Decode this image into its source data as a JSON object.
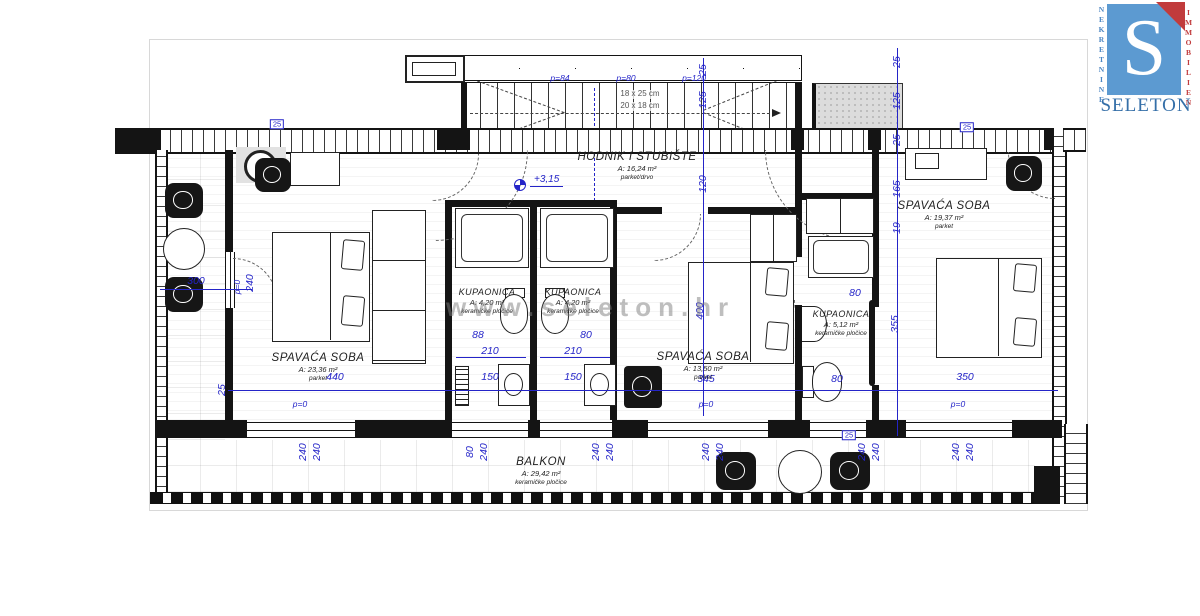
{
  "logo": {
    "letter": "S",
    "brand": "SELETON",
    "side_left": "NEKRETNINE",
    "side_right": "IMMOBILIEN",
    "blue": "#5c9ad1",
    "red": "#c13b3c",
    "brand_blue": "#356fa8"
  },
  "watermark": {
    "text": "www.seleton.hr"
  },
  "plan": {
    "level_marker": "+3,15",
    "stairs": {
      "note1": "18 x 25 cm",
      "note2": "20 x 18 cm"
    },
    "dim_color": "#2424c8",
    "rooms": [
      {
        "id": "hodnik",
        "name": "HODNIK I STUBIŠTE",
        "area": "A: 16,24 m²",
        "floor": "parket/drvo"
      },
      {
        "id": "bedroom-left",
        "name": "SPAVAĆA SOBA",
        "area": "A: 23,36 m²",
        "floor": "parket"
      },
      {
        "id": "bathroom-1",
        "name": "KUPAONICA",
        "area": "A: 4,20 m²",
        "floor": "keramičke pločice"
      },
      {
        "id": "bathroom-2",
        "name": "KUPAONICA",
        "area": "A: 4,20 m²",
        "floor": "keramičke pločice"
      },
      {
        "id": "bedroom-middle",
        "name": "SPAVAĆA SOBA",
        "area": "A: 13,50 m²",
        "floor": "parket"
      },
      {
        "id": "bathroom-3",
        "name": "KUPAONICA",
        "area": "A: 5,12 m²",
        "floor": "keramičke pločice"
      },
      {
        "id": "bedroom-right",
        "name": "SPAVAĆA SOBA",
        "area": "A: 19,37 m²",
        "floor": "parket"
      },
      {
        "id": "balkon",
        "name": "BALKON",
        "area": "A: 29,42 m²",
        "floor": "keramičke pločice"
      }
    ],
    "dimensions": [
      {
        "t": "440",
        "x": 335,
        "y": 377
      },
      {
        "t": "150",
        "x": 490,
        "y": 377
      },
      {
        "t": "150",
        "x": 573,
        "y": 377
      },
      {
        "t": "345",
        "x": 706,
        "y": 379
      },
      {
        "t": "80",
        "x": 837,
        "y": 379
      },
      {
        "t": "350",
        "x": 965,
        "y": 377
      },
      {
        "t": "88",
        "x": 478,
        "y": 335
      },
      {
        "t": "210",
        "x": 490,
        "y": 351
      },
      {
        "t": "80",
        "x": 586,
        "y": 335
      },
      {
        "t": "210",
        "x": 573,
        "y": 351
      },
      {
        "t": "80",
        "x": 855,
        "y": 293
      },
      {
        "t": "300",
        "x": 196,
        "y": 281
      },
      {
        "t": "25",
        "x": 897,
        "y": 62,
        "rot": -90
      },
      {
        "t": "125",
        "x": 897,
        "y": 101,
        "rot": -90
      },
      {
        "t": "25",
        "x": 897,
        "y": 140,
        "rot": -90
      },
      {
        "t": "165",
        "x": 897,
        "y": 189,
        "rot": -90
      },
      {
        "t": "19",
        "x": 897,
        "y": 228,
        "rot": -90
      },
      {
        "t": "355",
        "x": 895,
        "y": 324,
        "rot": -90
      },
      {
        "t": "25",
        "x": 703,
        "y": 70,
        "rot": -90
      },
      {
        "t": "125",
        "x": 703,
        "y": 100,
        "rot": -90
      },
      {
        "t": "120",
        "x": 703,
        "y": 184,
        "rot": -90
      },
      {
        "t": "400",
        "x": 700,
        "y": 311,
        "rot": -90
      },
      {
        "t": "25",
        "x": 222,
        "y": 390,
        "rot": -90
      },
      {
        "t": "240",
        "x": 303,
        "y": 452,
        "rot": -90
      },
      {
        "t": "240",
        "x": 317,
        "y": 452,
        "rot": -90
      },
      {
        "t": "80",
        "x": 470,
        "y": 452,
        "rot": -90
      },
      {
        "t": "240",
        "x": 484,
        "y": 452,
        "rot": -90
      },
      {
        "t": "240",
        "x": 596,
        "y": 452,
        "rot": -90
      },
      {
        "t": "240",
        "x": 610,
        "y": 452,
        "rot": -90
      },
      {
        "t": "240",
        "x": 706,
        "y": 452,
        "rot": -90
      },
      {
        "t": "240",
        "x": 720,
        "y": 452,
        "rot": -90
      },
      {
        "t": "240",
        "x": 862,
        "y": 452,
        "rot": -90
      },
      {
        "t": "240",
        "x": 876,
        "y": 452,
        "rot": -90
      },
      {
        "t": "240",
        "x": 956,
        "y": 452,
        "rot": -90
      },
      {
        "t": "240",
        "x": 970,
        "y": 452,
        "rot": -90
      },
      {
        "t": "240",
        "x": 250,
        "y": 283,
        "rot": -90
      },
      {
        "t": "p=0",
        "x": 237,
        "y": 287,
        "rot": -90,
        "style": "label"
      },
      {
        "t": "p=0",
        "x": 300,
        "y": 404,
        "style": "label"
      },
      {
        "t": "p=0",
        "x": 706,
        "y": 404,
        "style": "label"
      },
      {
        "t": "p=0",
        "x": 958,
        "y": 404,
        "style": "label"
      },
      {
        "t": "p=84",
        "x": 560,
        "y": 78,
        "style": "label"
      },
      {
        "t": "p=80",
        "x": 626,
        "y": 78,
        "style": "label"
      },
      {
        "t": "p=120",
        "x": 694,
        "y": 78,
        "style": "label"
      },
      {
        "t": "25",
        "x": 277,
        "y": 124,
        "style": "boxed"
      },
      {
        "t": "25",
        "x": 967,
        "y": 127,
        "style": "boxed"
      },
      {
        "t": "25",
        "x": 849,
        "y": 435,
        "style": "boxed"
      }
    ]
  }
}
